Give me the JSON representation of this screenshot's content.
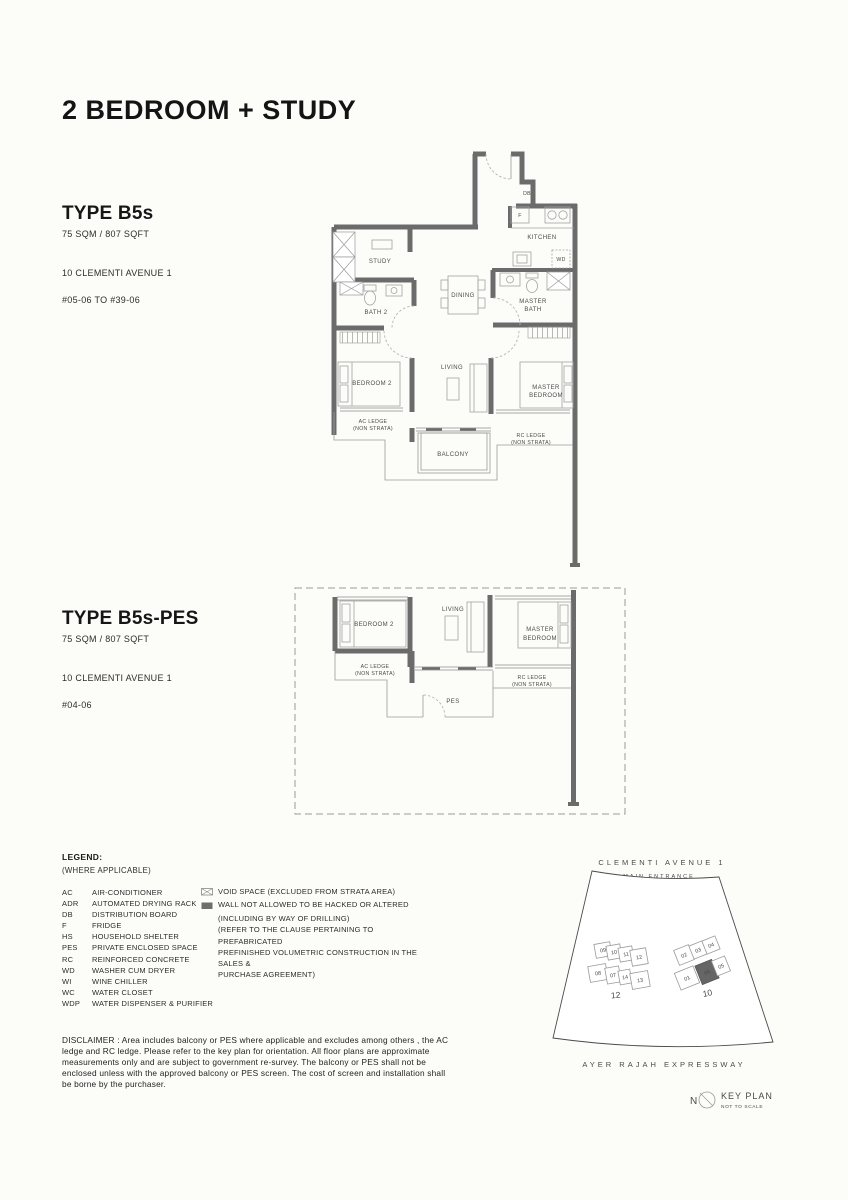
{
  "page_title": "2 BEDROOM + STUDY",
  "units": [
    {
      "name": "TYPE B5s",
      "area": "75 SQM / 807 SQFT",
      "address": "10 CLEMENTI AVENUE 1",
      "levels": "#05-06 TO  #39-06"
    },
    {
      "name": "TYPE B5s-PES",
      "area": "75 SQM / 807 SQFT",
      "address": "10 CLEMENTI AVENUE 1",
      "levels": "#04-06"
    }
  ],
  "plan1": {
    "labels": {
      "db": "DB",
      "f": "F",
      "kitchen": "KITCHEN",
      "wd": "WD",
      "study": "STUDY",
      "bath2": "BATH 2",
      "dining": "DINING",
      "master_bath1": "MASTER",
      "master_bath2": "BATH",
      "bedroom2": "BEDROOM 2",
      "living": "LIVING",
      "master_bed1": "MASTER",
      "master_bed2": "BEDROOM",
      "ac1": "AC LEDGE",
      "ac2": "(NON STRATA)",
      "rc1": "RC LEDGE",
      "rc2": "(NON STRATA)",
      "balcony": "BALCONY"
    }
  },
  "plan2": {
    "labels": {
      "bedroom2": "BEDROOM 2",
      "living": "LIVING",
      "master_bed1": "MASTER",
      "master_bed2": "BEDROOM",
      "ac1": "AC LEDGE",
      "ac2": "(NON STRATA)",
      "rc1": "RC LEDGE",
      "rc2": "(NON STRATA)",
      "pes": "PES"
    }
  },
  "legend": {
    "title": "LEGEND:",
    "subtitle": "(WHERE APPLICABLE)",
    "items": [
      {
        "abbr": "AC",
        "desc": "AIR-CONDITIONER"
      },
      {
        "abbr": "ADR",
        "desc": "AUTOMATED DRYING RACK"
      },
      {
        "abbr": "DB",
        "desc": "DISTRIBUTION BOARD"
      },
      {
        "abbr": "F",
        "desc": "FRIDGE"
      },
      {
        "abbr": "HS",
        "desc": "HOUSEHOLD SHELTER"
      },
      {
        "abbr": "PES",
        "desc": "PRIVATE ENCLOSED SPACE"
      },
      {
        "abbr": "RC",
        "desc": "REINFORCED CONCRETE"
      },
      {
        "abbr": "WD",
        "desc": "WASHER CUM DRYER"
      },
      {
        "abbr": "WI",
        "desc": "WINE CHILLER"
      },
      {
        "abbr": "WC",
        "desc": "WATER CLOSET"
      },
      {
        "abbr": "WDP",
        "desc": "WATER DISPENSER & PURIFIER"
      }
    ],
    "notes": {
      "void": "VOID SPACE (EXCLUDED FROM STRATA AREA)",
      "wall_l1": "WALL NOT ALLOWED TO BE HACKED OR ALTERED",
      "wall_l2": "(INCLUDING BY WAY OF DRILLING)",
      "wall_l3": "(REFER TO THE CLAUSE PERTAINING TO PREFABRICATED",
      "wall_l4": "PREFINISHED VOLUMETRIC CONSTRUCTION IN THE SALES &",
      "wall_l5": "PURCHASE AGREEMENT)"
    }
  },
  "disclaimer": "DISCLAIMER : Area includes balcony or PES where applicable and excludes among others , the AC ledge and RC ledge. Please refer to the key plan for orientation. All floor plans are approximate measurements only and are subject to government re-survey. The balcony or PES shall not be enclosed unless with the approved balcony or PES screen. The cost of screen and installation shall be borne by the purchaser.",
  "keyplan": {
    "road_top": "CLEMENTI AVENUE 1",
    "main_entrance": "MAIN ENTRANCE",
    "road_bottom": "AYER RAJAH EXPRESSWAY",
    "north": "N",
    "title": "KEY PLAN",
    "scale_note": "NOT TO SCALE",
    "block12_label": "12",
    "block10_label": "10",
    "block12_units": [
      "09",
      "10",
      "11",
      "12",
      "08",
      "07",
      "14",
      "13"
    ],
    "block10_units": [
      "02",
      "03",
      "04",
      "01",
      "06",
      "05"
    ],
    "highlighted_unit": "06"
  },
  "colors": {
    "wall": "#6b6b6b",
    "highlight": "#666666"
  }
}
